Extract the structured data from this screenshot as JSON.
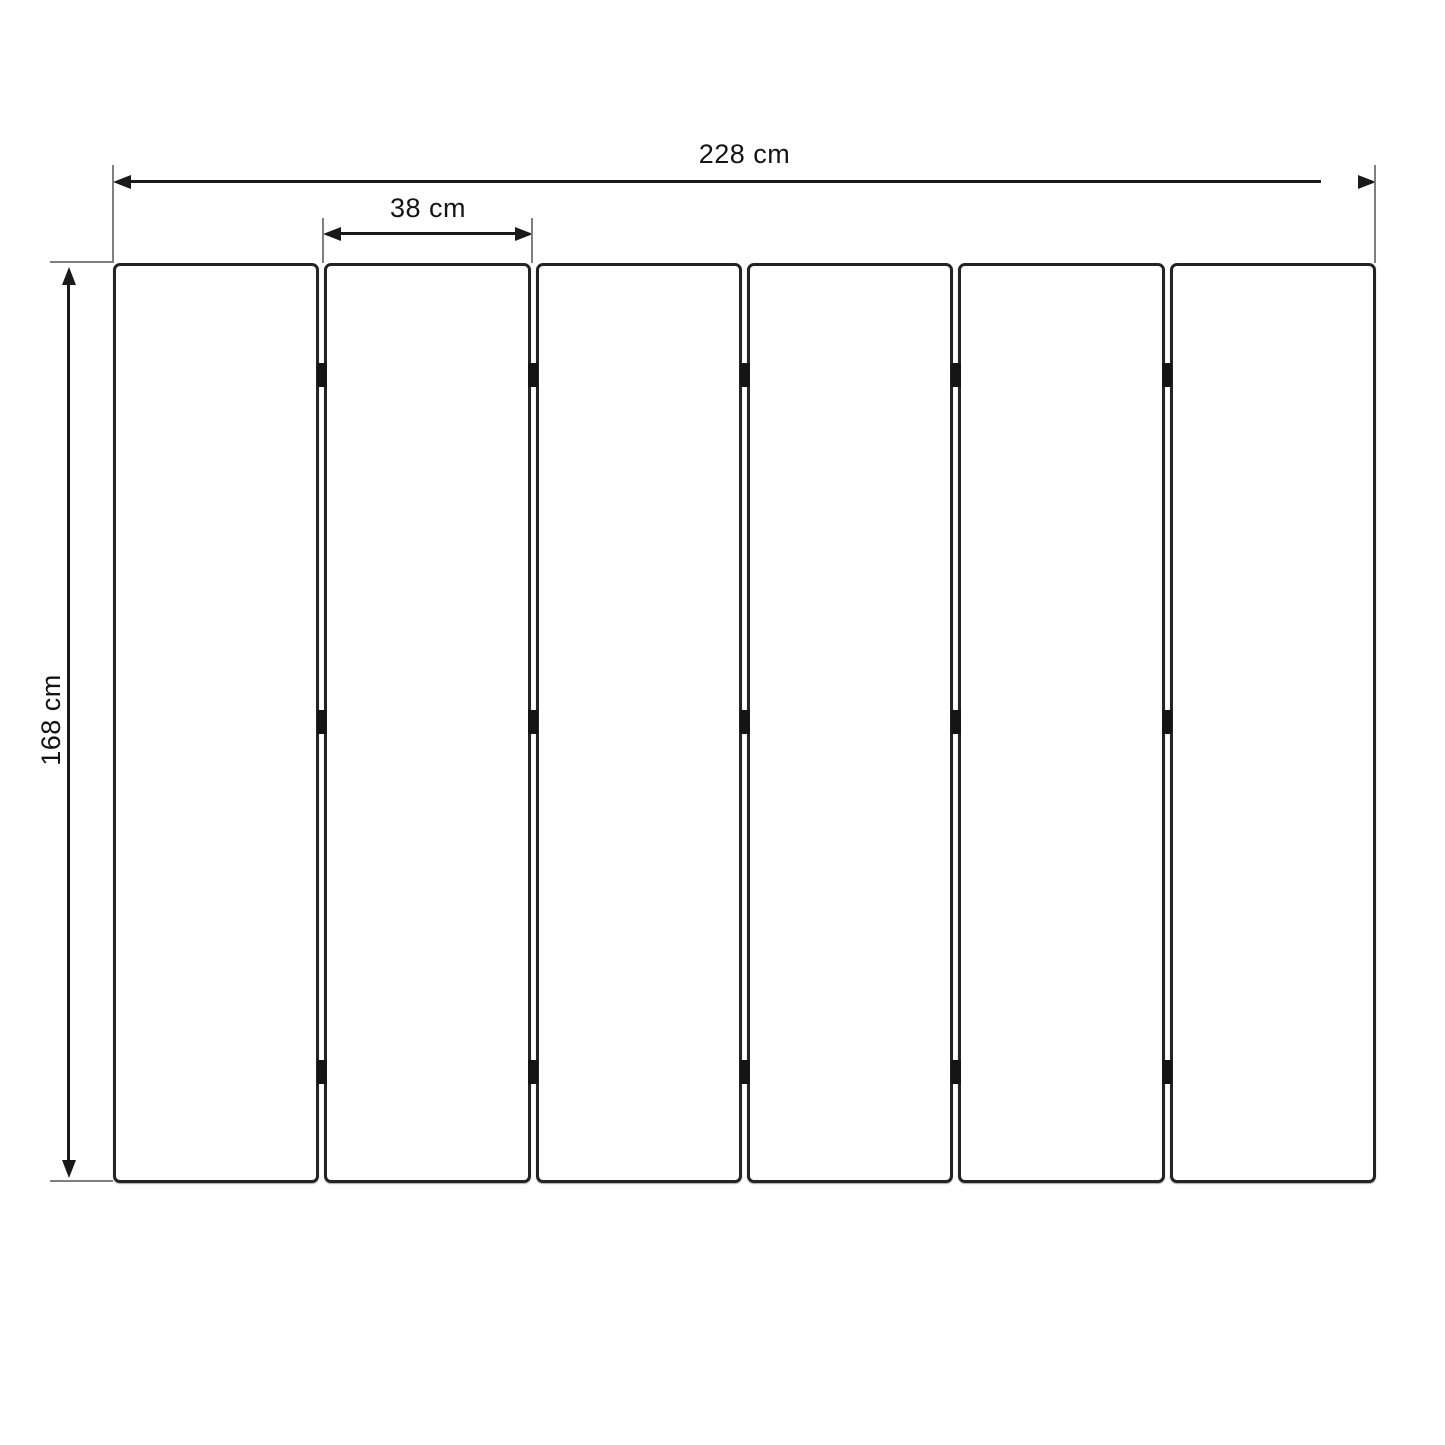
{
  "diagram": {
    "type": "technical-dimension-drawing",
    "dimensions": {
      "total_width_label": "228 cm",
      "panel_width_label": "38 cm",
      "height_label": "168 cm"
    },
    "panels": {
      "count": 6,
      "gaps": 5,
      "hinges_per_gap": 3,
      "hinge_positions_pct": [
        12.2,
        49.9,
        87.9
      ]
    },
    "colors": {
      "background": "#ffffff",
      "dimension_line": "#1a1a1a",
      "extension_line": "#7f7f7f",
      "panel_border": "#242424",
      "hinge": "#141414",
      "label_text": "#141414"
    }
  }
}
